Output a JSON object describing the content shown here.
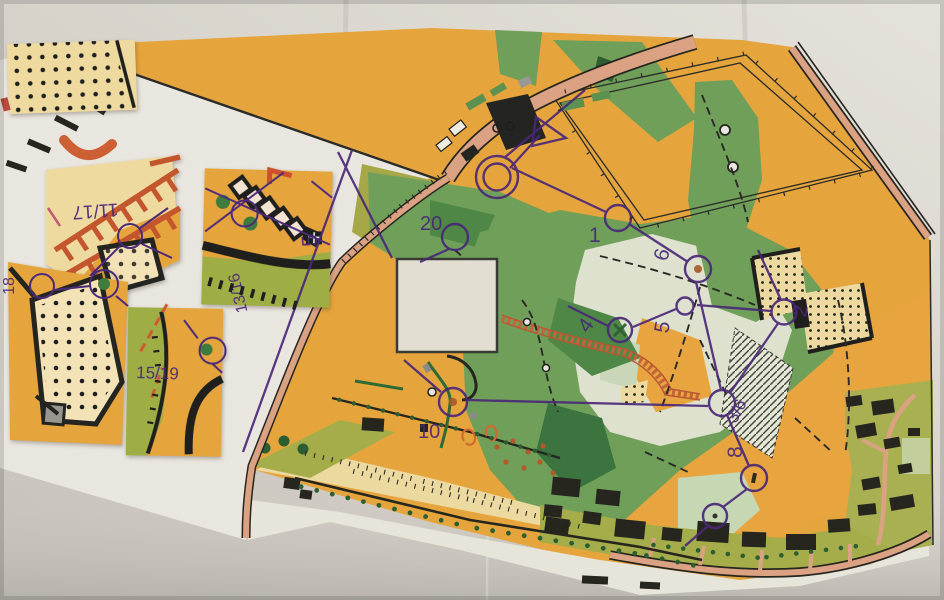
{
  "colors": {
    "paper": "#d7d3cb",
    "map_white": "#e9e6df",
    "open_orange": "#e5a43c",
    "rough_pale": "#ecd9a0",
    "olive_green": "#a6a746",
    "mid_green": "#6f9f59",
    "dark_green": "#3c7440",
    "pale_clearing": "#dde1cd",
    "road_salmon": "#dba183",
    "symbol_black": "#26261f",
    "overprint_purple": "#4a2878",
    "ladder_red": "#c4562e",
    "brown_dot": "#b35a2a"
  },
  "main_map": {
    "controls": [
      {
        "label": "20"
      },
      {
        "label": "1"
      },
      {
        "label": "6"
      },
      {
        "label": "4"
      },
      {
        "label": "5"
      },
      {
        "label": "2"
      },
      {
        "label": "3/6"
      },
      {
        "label": "8"
      },
      {
        "label": "10"
      }
    ]
  },
  "fragments": {
    "f1": {
      "label": "11/17"
    },
    "f2": {
      "label": "13/16",
      "secondary_label": "5"
    },
    "f3": {
      "label": "18"
    },
    "f4": {
      "label": "15/19"
    }
  }
}
